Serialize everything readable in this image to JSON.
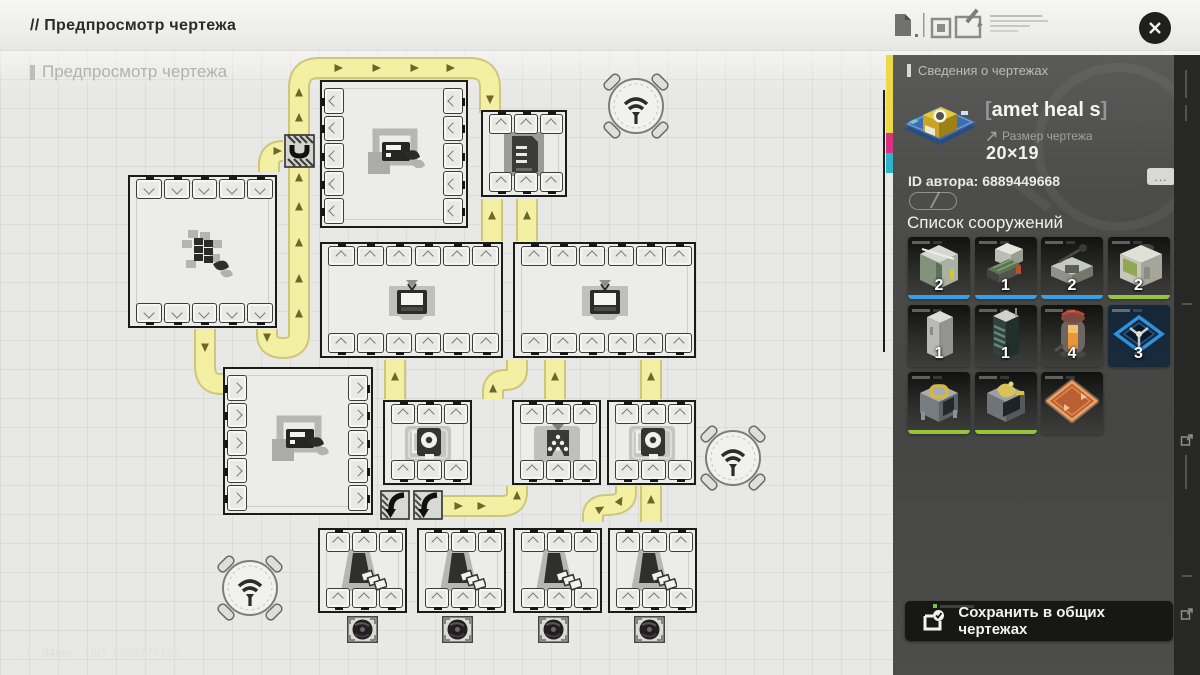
{
  "header": {
    "title": "// Предпросмотр чертежа"
  },
  "watermark": "Предпросмотр чертежа",
  "status_bar": {
    "ping": "84ms",
    "uid": "UID: 6493777722"
  },
  "sidebar": {
    "title": "Сведения о чертежах",
    "item_name": "amet heal s",
    "bracket_open": "[",
    "bracket_close": "]",
    "size_label": "Размер чертежа",
    "size_value": "20×19",
    "author_id": "ID автора: 6889449668",
    "more_label": "...",
    "structures_title": "Список сооружений",
    "save_label": "Сохранить в общих чертежах",
    "structures": [
      {
        "count": "2",
        "bar": "#35a1e8",
        "art": "assembler"
      },
      {
        "count": "1",
        "bar": "#35a1e8",
        "art": "belt"
      },
      {
        "count": "2",
        "bar": "#35a1e8",
        "art": "arm"
      },
      {
        "count": "2",
        "bar": "#96c43e",
        "art": "boxm"
      },
      {
        "count": "1",
        "bar": "",
        "art": "cabinet"
      },
      {
        "count": "1",
        "bar": "",
        "art": "tower"
      },
      {
        "count": "4",
        "bar": "",
        "art": "furnace"
      },
      {
        "count": "3",
        "bar": "",
        "art": "diamond"
      },
      {
        "count": "",
        "bar": "#96c43e",
        "art": "crateo"
      },
      {
        "count": "",
        "bar": "#96c43e",
        "art": "cratehand"
      },
      {
        "count": "",
        "bar": "",
        "art": "pad"
      }
    ]
  },
  "colors": {
    "accent_yellow": "#ecd94a",
    "accent_magenta": "#d8317f",
    "accent_cyan": "#2ab5c9",
    "conveyor_fill": "#f3efa3",
    "conveyor_edge": "#cdc67b",
    "conveyor_arrow": "#6d6828",
    "count_bar_blue": "#35a1e8",
    "count_bar_green": "#96c43e"
  },
  "blueprint": {
    "machines": [
      {
        "id": "refiner-top",
        "x": 320,
        "y": 80,
        "w": 148,
        "h": 148,
        "ports": "lr",
        "np": 5,
        "chev": "<",
        "icon": "printer"
      },
      {
        "id": "depot-top",
        "x": 481,
        "y": 110,
        "w": 86,
        "h": 87,
        "ports": "tb",
        "np": 3,
        "chev": "^",
        "icon": "rack"
      },
      {
        "id": "solar-left",
        "x": 128,
        "y": 175,
        "w": 149,
        "h": 153,
        "ports": "tb",
        "np": 5,
        "chev": "v",
        "icon": "solar"
      },
      {
        "id": "wide-a",
        "x": 320,
        "y": 242,
        "w": 183,
        "h": 116,
        "ports": "tb",
        "np": 6,
        "chev": "^",
        "icon": "tv"
      },
      {
        "id": "wide-b",
        "x": 513,
        "y": 242,
        "w": 183,
        "h": 116,
        "ports": "tb",
        "np": 6,
        "chev": "^",
        "icon": "tv"
      },
      {
        "id": "refiner-mid",
        "x": 223,
        "y": 367,
        "w": 150,
        "h": 148,
        "ports": "lr",
        "np": 5,
        "chev": ">",
        "icon": "printer"
      },
      {
        "id": "proc-1",
        "x": 383,
        "y": 400,
        "w": 89,
        "h": 85,
        "ports": "tb",
        "np": 3,
        "chev": "^",
        "icon": "heartbox"
      },
      {
        "id": "proc-2",
        "x": 512,
        "y": 400,
        "w": 89,
        "h": 85,
        "ports": "tb",
        "np": 3,
        "chev": "^",
        "icon": "crusher"
      },
      {
        "id": "proc-3",
        "x": 607,
        "y": 400,
        "w": 89,
        "h": 85,
        "ports": "tb",
        "np": 3,
        "chev": "^",
        "icon": "heartbox"
      },
      {
        "id": "miner-1",
        "x": 318,
        "y": 528,
        "w": 89,
        "h": 85,
        "ports": "tb",
        "np": 3,
        "chev": "^",
        "icon": "drill"
      },
      {
        "id": "miner-2",
        "x": 417,
        "y": 528,
        "w": 89,
        "h": 85,
        "ports": "tb",
        "np": 3,
        "chev": "^",
        "icon": "drill"
      },
      {
        "id": "miner-3",
        "x": 513,
        "y": 528,
        "w": 89,
        "h": 85,
        "ports": "tb",
        "np": 3,
        "chev": "^",
        "icon": "drill"
      },
      {
        "id": "miner-4",
        "x": 608,
        "y": 528,
        "w": 89,
        "h": 85,
        "ports": "tb",
        "np": 3,
        "chev": "^",
        "icon": "drill"
      }
    ],
    "antennas": [
      {
        "x": 636,
        "y": 106
      },
      {
        "x": 733,
        "y": 458
      },
      {
        "x": 250,
        "y": 588
      }
    ],
    "splitters": [
      {
        "x": 284,
        "y": 134
      }
    ],
    "turners": [
      {
        "x": 380,
        "y": 490
      },
      {
        "x": 413,
        "y": 490
      }
    ],
    "fans": [
      {
        "x": 347,
        "y": 616
      },
      {
        "x": 442,
        "y": 616
      },
      {
        "x": 538,
        "y": 616
      },
      {
        "x": 634,
        "y": 616
      }
    ],
    "conveyor_paths": [
      "M 267 329 L 267 334 Q 267 348 283 348 Q 299 348 299 334 L 299 88 Q 299 68 319 68 L 470 68 Q 490 68 490 88 L 490 113",
      "M 283 151 Q 269 151 269 165 L 269 172",
      "M 205 329 L 205 366 Q 205 384 221 384 L 226 384",
      "M 492 199 L 492 241",
      "M 527 199 L 527 241",
      "M 395 360 L 395 399",
      "M 555 360 L 555 399",
      "M 651 360 L 651 399",
      "M 493 399 L 493 392 Q 493 380 505 380 Q 517 380 517 370 L 517 360",
      "M 443 506 L 502 506 Q 517 506 517 492 L 517 486",
      "M 593 522 L 593 516 Q 593 505 607 505 Q 626 505 626 493 L 626 486",
      "M 651 522 L 651 486"
    ],
    "arrows": [
      [
        299,
        314,
        0
      ],
      [
        299,
        279,
        0
      ],
      [
        299,
        243,
        0
      ],
      [
        299,
        207,
        0
      ],
      [
        299,
        178,
        0
      ],
      [
        299,
        118,
        0
      ],
      [
        299,
        93,
        0
      ],
      [
        338,
        68,
        90
      ],
      [
        376,
        68,
        90
      ],
      [
        414,
        68,
        90
      ],
      [
        450,
        68,
        90
      ],
      [
        490,
        99,
        180
      ],
      [
        277,
        151,
        90
      ],
      [
        205,
        347,
        180
      ],
      [
        267,
        337,
        180
      ],
      [
        492,
        216,
        0
      ],
      [
        527,
        216,
        0
      ],
      [
        395,
        377,
        0
      ],
      [
        555,
        377,
        0
      ],
      [
        651,
        377,
        0
      ],
      [
        493,
        389,
        0
      ],
      [
        458,
        506,
        90
      ],
      [
        481,
        506,
        90
      ],
      [
        517,
        496,
        0
      ],
      [
        600,
        509,
        60
      ],
      [
        620,
        501,
        30
      ],
      [
        651,
        500,
        0
      ]
    ]
  }
}
